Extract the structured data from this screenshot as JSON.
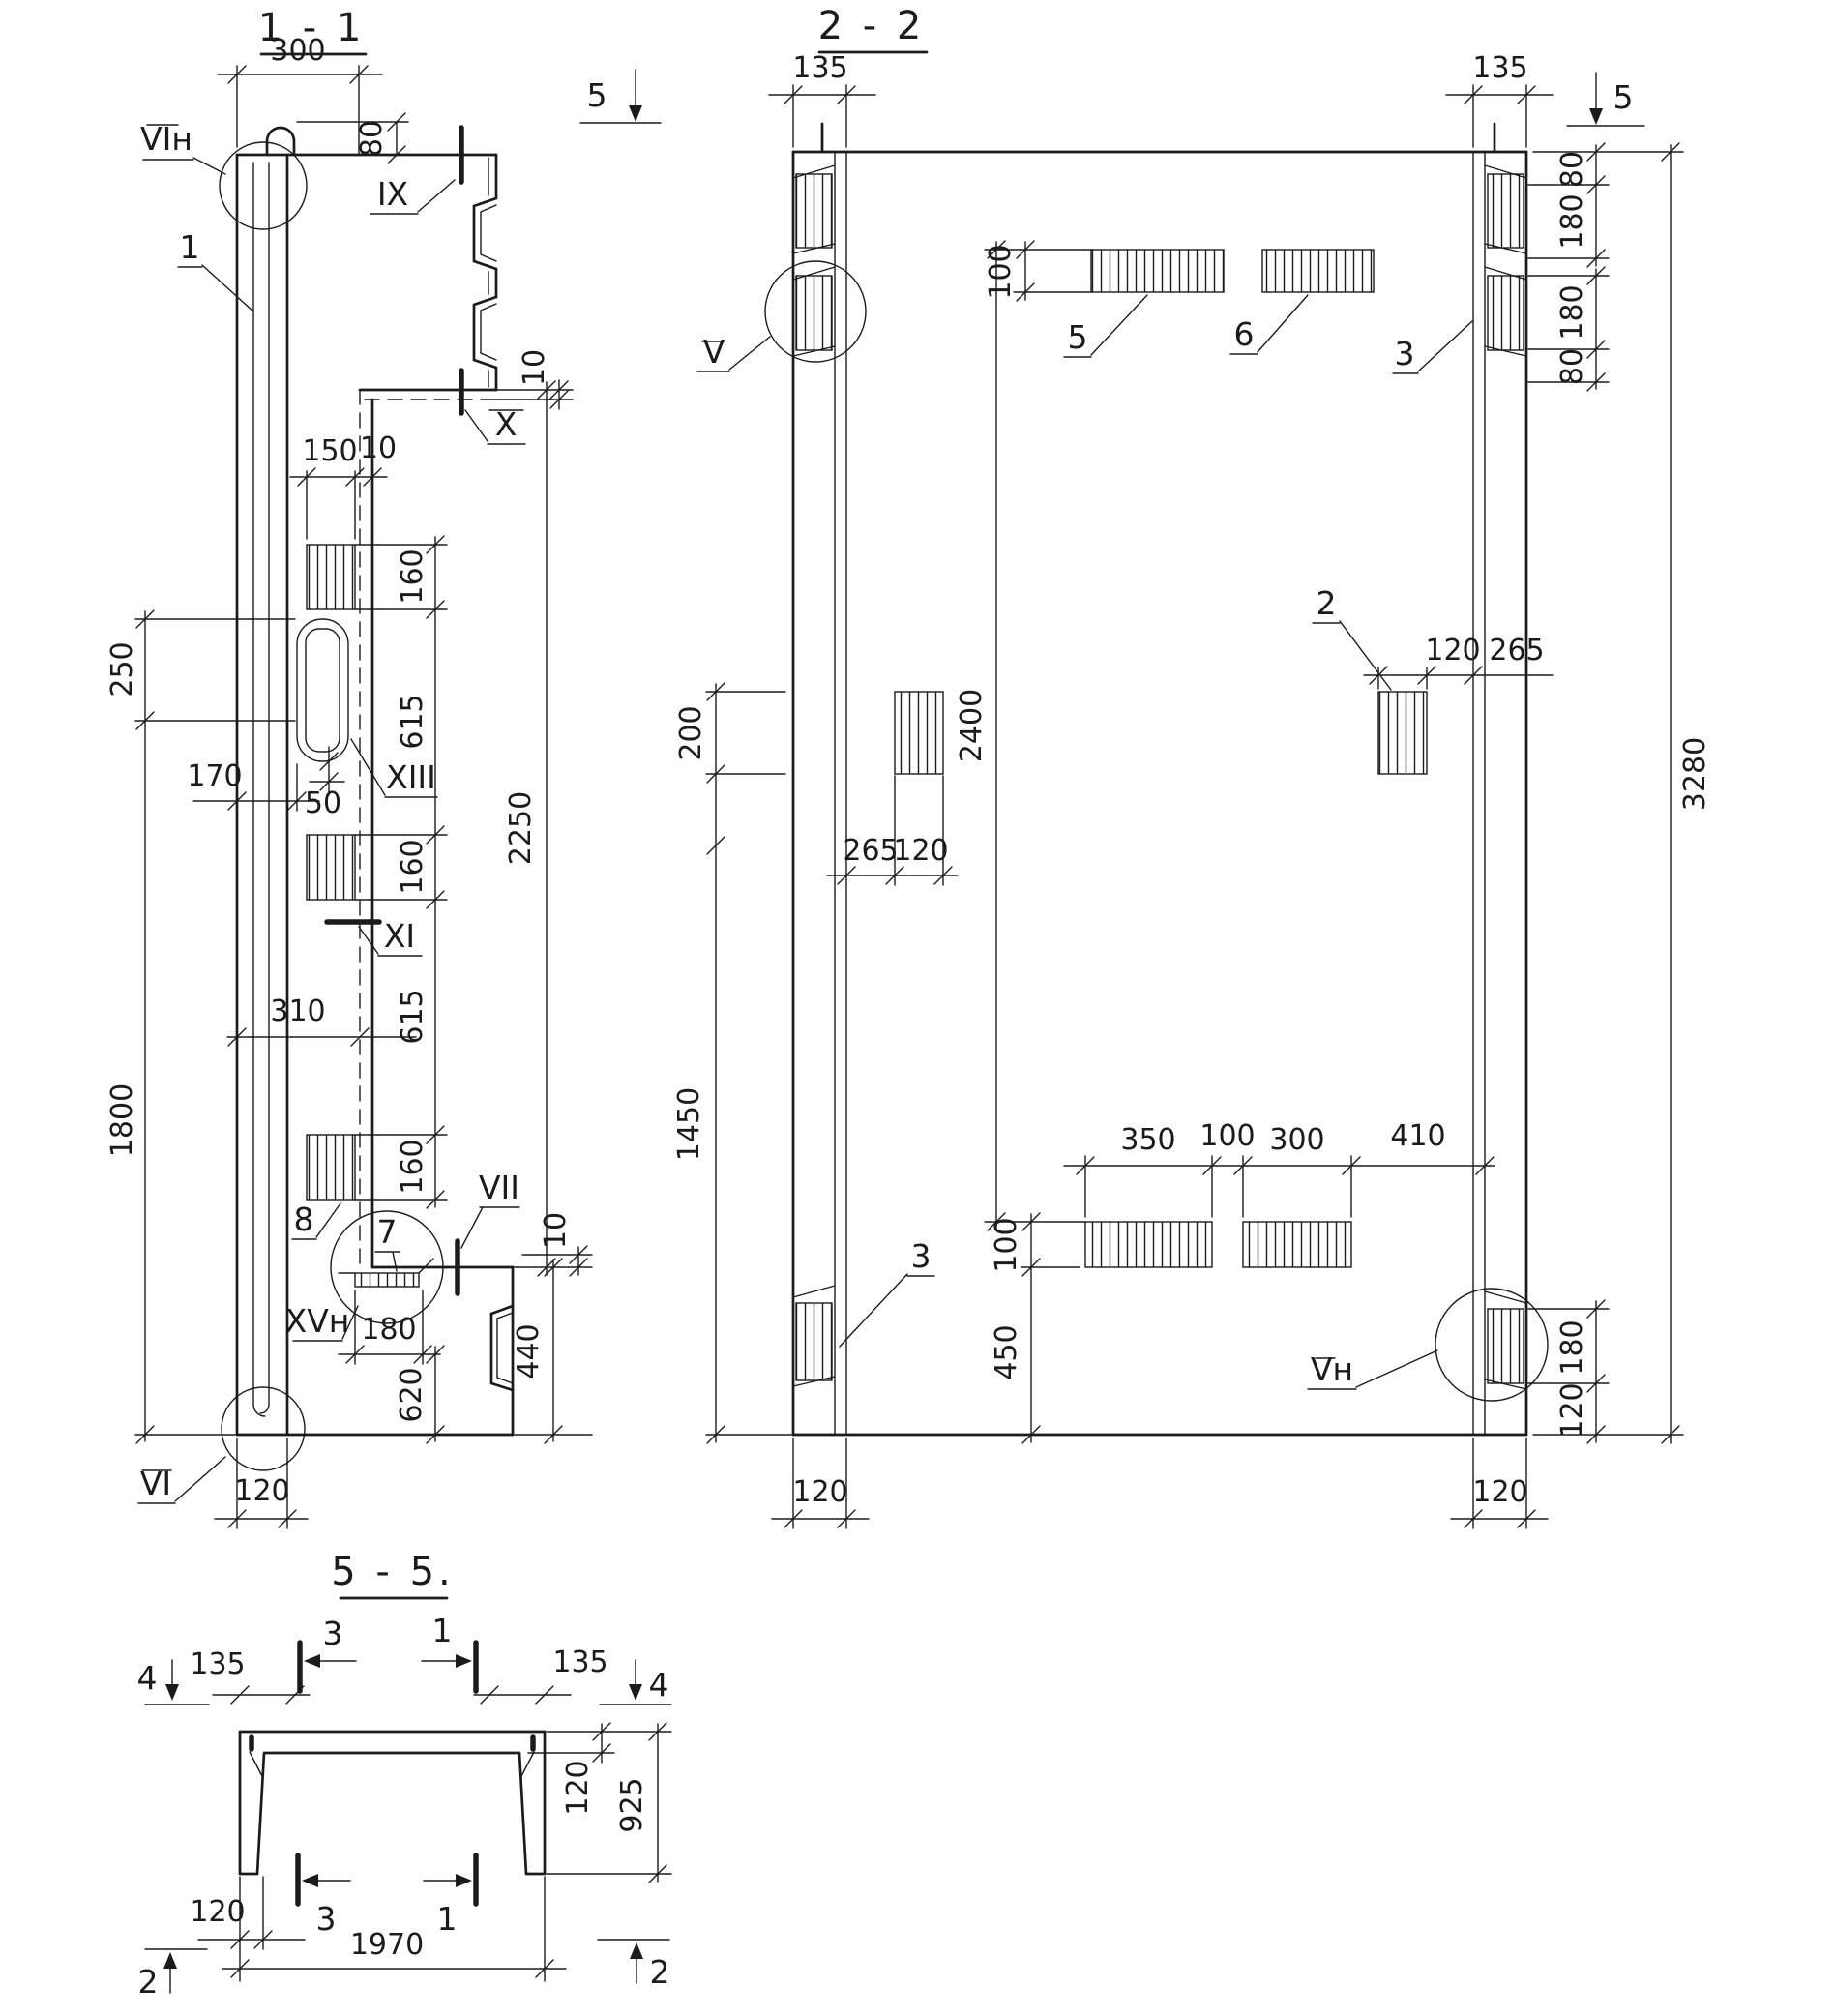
{
  "colors": {
    "ink": "#1b1b1b",
    "paper": "#ffffff"
  },
  "s11": {
    "title": "1 - 1",
    "d300": "300",
    "d80": "80",
    "l_vin": "VIн",
    "l_ix": "IX",
    "l_1": "1",
    "l_x": "X",
    "d10_step": "10",
    "d150": "150",
    "d10_gap": "10",
    "d160_1": "160",
    "d250": "250",
    "d615_1": "615",
    "l_xiii": "XIII",
    "d170": "170",
    "d50": "50",
    "d160_2": "160",
    "l_xi": "XI",
    "d310": "310",
    "d615_2": "615",
    "d1800": "1800",
    "d160_3": "160",
    "l_8": "8",
    "d2250": "2250",
    "l_7": "7",
    "l_vii": "VII",
    "l_xvn": "XVн",
    "d10_b": "10",
    "d440": "440",
    "d180": "180",
    "d620": "620",
    "l_vi": "VI",
    "d120": "120"
  },
  "s22": {
    "title": "2 - 2",
    "m5l": "5",
    "d135l": "135",
    "d135r": "135",
    "m5r": "5",
    "l_v": "V",
    "d100t": "100",
    "l_5": "5",
    "l_6": "6",
    "l_3t": "3",
    "d80a": "80",
    "d180a": "180",
    "d180b": "180",
    "d80b": "80",
    "d3280": "3280",
    "d200": "200",
    "d2400": "2400",
    "l_2": "2",
    "d265l": "265",
    "d120l": "120",
    "d120r": "120",
    "d265r": "265",
    "d1450": "1450",
    "l_3b": "3",
    "d350": "350",
    "d100m": "100",
    "d300": "300",
    "d410": "410",
    "d100b": "100",
    "d450": "450",
    "l_vn": "Vн",
    "d180c": "180",
    "d120c": "120",
    "d120bl": "120",
    "d120br": "120"
  },
  "s55": {
    "title": "5 - 5.",
    "m4l": "4",
    "d135l": "135",
    "m3t": "3",
    "m1t": "1",
    "d135r": "135",
    "m4r": "4",
    "d120top": "120",
    "d925": "925",
    "d120bot": "120",
    "d1970": "1970",
    "m3b": "3",
    "m1b": "1",
    "m2l": "2",
    "m2r": "2"
  }
}
